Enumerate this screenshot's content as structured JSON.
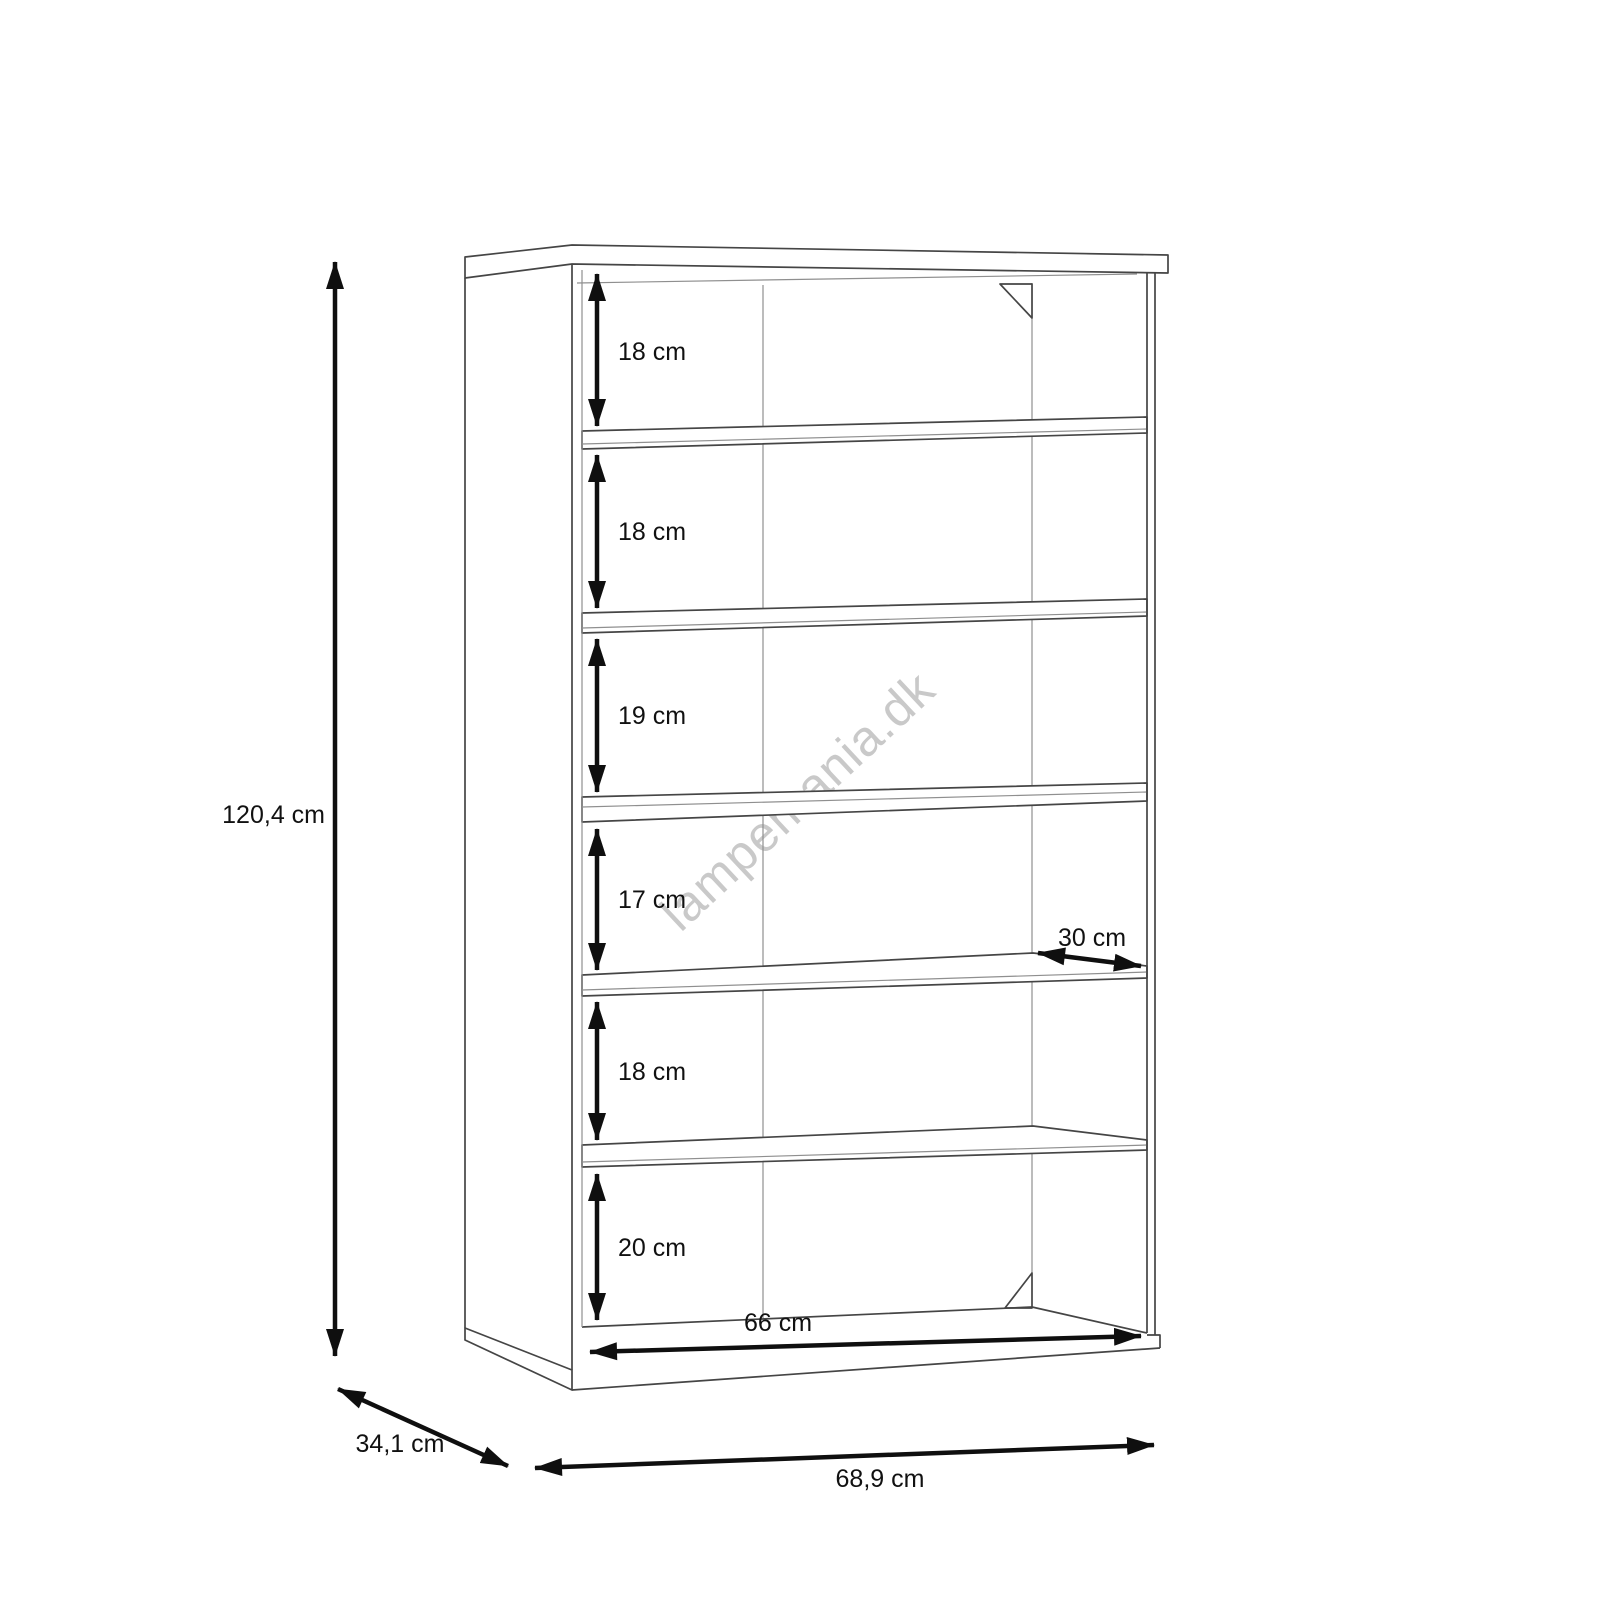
{
  "watermark": {
    "text": "lampemania.dk",
    "color": "#c9c9c9"
  },
  "diagram": {
    "type": "furniture-dimension-drawing",
    "object": "open shelving unit / bookcase with 6 compartments",
    "units": "cm",
    "overall": {
      "height_label": "120,4 cm",
      "width_label": "68,9 cm",
      "depth_label": "34,1 cm"
    },
    "interior": {
      "inner_width_label": "66 cm",
      "shelf_depth_label": "30 cm"
    },
    "compartments": [
      {
        "position": 1,
        "label": "18 cm"
      },
      {
        "position": 2,
        "label": "18 cm"
      },
      {
        "position": 3,
        "label": "19 cm"
      },
      {
        "position": 4,
        "label": "17 cm"
      },
      {
        "position": 5,
        "label": "18 cm"
      },
      {
        "position": 6,
        "label": "20 cm"
      }
    ],
    "colors": {
      "background": "#ffffff",
      "cabinet_line": "#454545",
      "dimension_line": "#0f0f0f",
      "watermark": "#c9c9c9"
    }
  }
}
